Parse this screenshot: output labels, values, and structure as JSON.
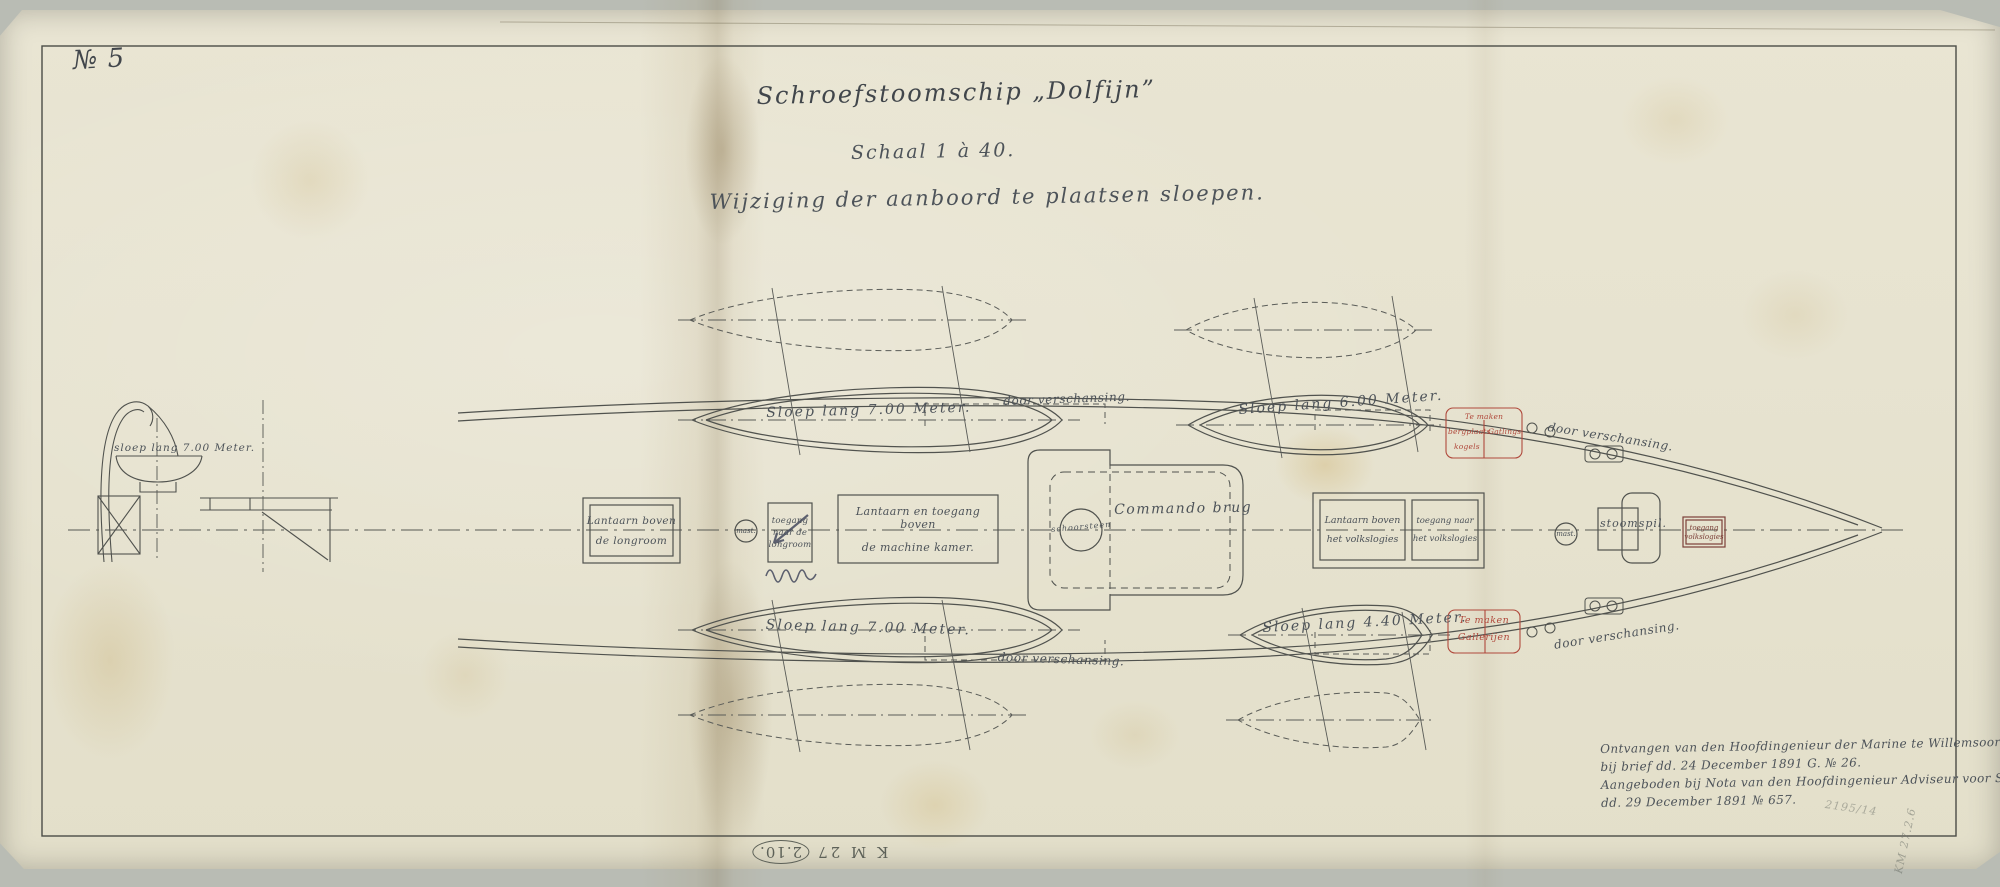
{
  "sheet": {
    "number": "№ 5"
  },
  "header": {
    "title": "Schroefstoomschip „Dolfijn”",
    "scale": "Schaal 1 à 40.",
    "subtitle": "Wijziging der aanboord te plaatsen sloepen."
  },
  "section_view": {
    "boat_label": "sloep lang 7.00 Meter."
  },
  "plan": {
    "sloop_upper_left": "Sloep lang 7.00 Meter.",
    "sloop_upper_right": "Sloep lang 6.00 Meter.",
    "sloop_lower_left": "Sloep lang 7.00 Meter.",
    "sloop_lower_right": "Sloep lang 4.40 Meter.",
    "bulwark_notes": {
      "ul": "door verschansing.",
      "ur": "door verschansing.",
      "ll": "door verschansing.",
      "lr": "door verschansing."
    },
    "deck": {
      "lantern_longroom_1": "Lantaarn boven",
      "lantern_longroom_2": "de longroom",
      "mast_fore": "mast.",
      "companion_longroom_1": "toegang",
      "companion_longroom_2": "naar de",
      "companion_longroom_3": "longroom",
      "lantern_engine_1": "Lantaarn en toegang boven",
      "lantern_engine_2": "de machine  kamer.",
      "funnel": "schoorsteen",
      "bridge": "Commando brug",
      "lantern_crew_1": "Lantaarn boven",
      "lantern_crew_2": "het volkslogies",
      "companion_crew_1": "toegang naar",
      "companion_crew_2": "het volkslogies",
      "mast_main": "mast.",
      "capstan": "stoomspil.",
      "hatch_crew_1": "toegang",
      "hatch_crew_2": "volkslogies"
    },
    "red_notes": {
      "upper_line1": "Te maken",
      "upper_cell_left": "bergplaats",
      "upper_cell_right": "Gatlings",
      "upper_line3": "kogels",
      "lower_line1": "Te maken",
      "lower_line2": "Gallerijen"
    }
  },
  "registration": {
    "line1": "Ontvangen van den Hoofdingenieur der Marine te Willemsoord",
    "line2": "bij brief dd. 24 December 1891 G. № 26.",
    "line3": "Aangeboden bij Nota van den Hoofdingenieur Adviseur voor Scheepsbouw",
    "line4": "dd. 29 December 1891 № 657."
  },
  "marks": {
    "stamp_prefix": "K M 27",
    "stamp_circled": "2.10.",
    "pencil_a": "2195/14",
    "pencil_b": "KM 27.2.6"
  },
  "colors": {
    "ink": "#4d5359",
    "red_ink": "#b0493c",
    "paper": "#e7e3d0"
  }
}
